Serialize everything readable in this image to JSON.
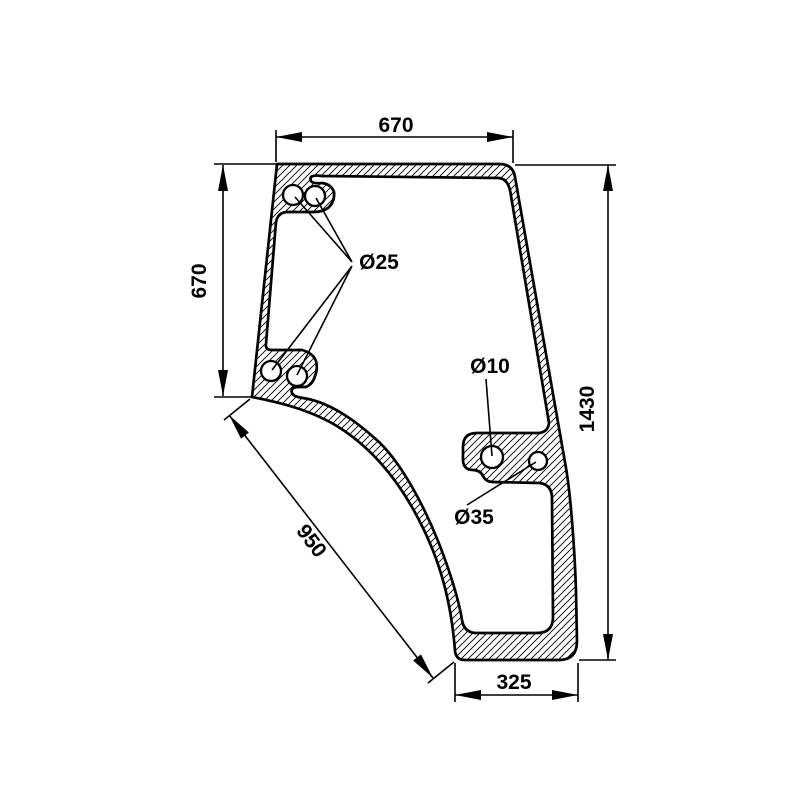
{
  "drawing": {
    "kind": "technical-drawing",
    "subject": "door-glass-panel",
    "canvas": {
      "background": "#ffffff",
      "line_color": "#000000"
    },
    "dimensions": {
      "top_width": "670",
      "left_height": "670",
      "right_height": "1430",
      "bottom_width": "325",
      "diagonal_length": "950"
    },
    "labels": {
      "mount_holes": "Ø25",
      "bracket_hole_small": "Ø10",
      "bracket_hole_large": "Ø35"
    }
  }
}
